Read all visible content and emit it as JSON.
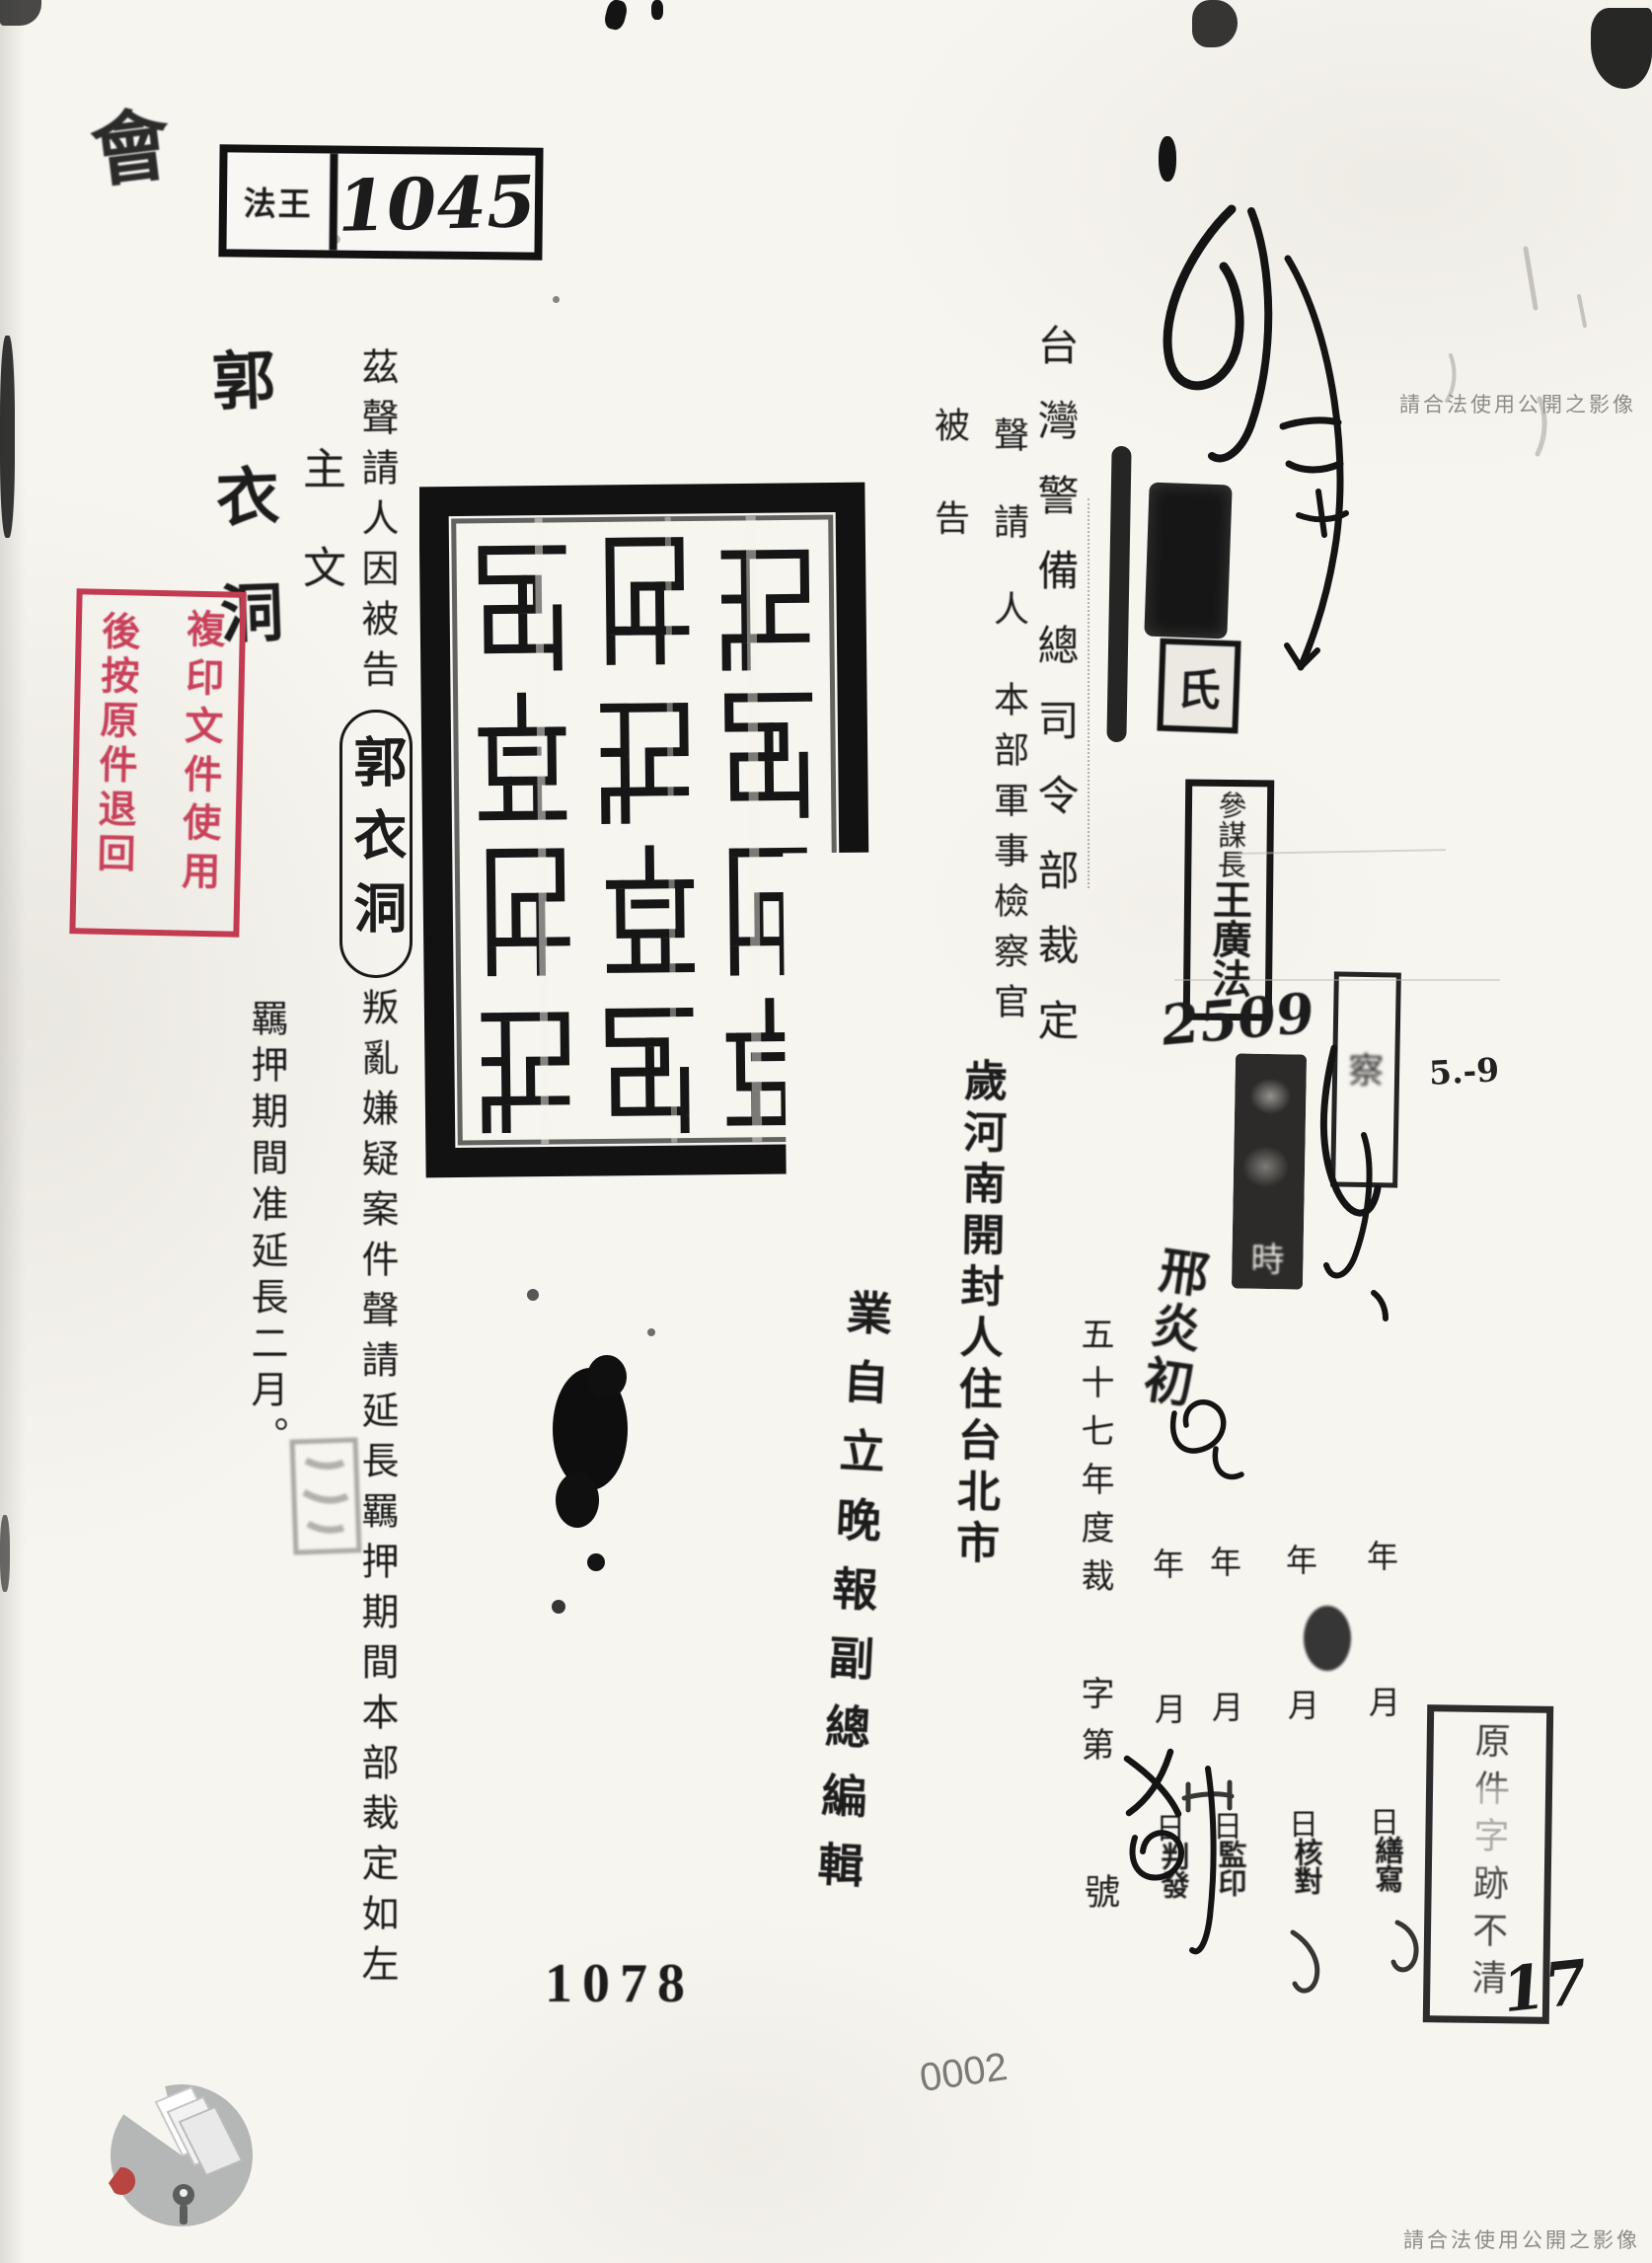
{
  "page": {
    "corner_scribble": "會",
    "watermark": "請合法使用公開之影像"
  },
  "file_box": {
    "label": "法王",
    "number": "1045"
  },
  "red_stamp": {
    "col_right": "複印文件使用",
    "col_left": "後按原件退回",
    "color": "#c23b51"
  },
  "title": "台灣警備總司令部裁定",
  "parties": {
    "applicant_label": "聲請人",
    "applicant": "本部軍事檢察官",
    "defendant_label": "被告"
  },
  "main": {
    "clause_prefix": "茲聲請人因被告",
    "defendant_handwritten": "郭衣洞",
    "clause_mid": "叛亂嫌疑案件聲請延",
    "clause_suffix": "長羈押期間本部裁定如左",
    "main_label": "主文",
    "ruling": "羈押期間准延長二月。"
  },
  "side_name": "郭衣洞",
  "defendant_info": {
    "residence": "歲河南開封人住台北市",
    "occupation": "業自立晚報副總編輯"
  },
  "annotations": {
    "chief_title": "參謀長",
    "chief_name": "王廣法",
    "number_hand": "2509",
    "date_hand": "5.-9",
    "signature_hand": "邢炎初",
    "received_char": "時",
    "side_stamp_char": "察",
    "redaction_char": "氏"
  },
  "case_no": {
    "year_line": "五十七年度裁",
    "zi_di": "字第",
    "hao": "號"
  },
  "process": {
    "year": "年",
    "month": "月",
    "day": "日",
    "labels": [
      "繕寫",
      "核對",
      "監印",
      "判發"
    ]
  },
  "unclear_box": "原件字跡不清",
  "footer": {
    "page_no": "1078",
    "scan_no": "0002",
    "hand_no": "17"
  }
}
